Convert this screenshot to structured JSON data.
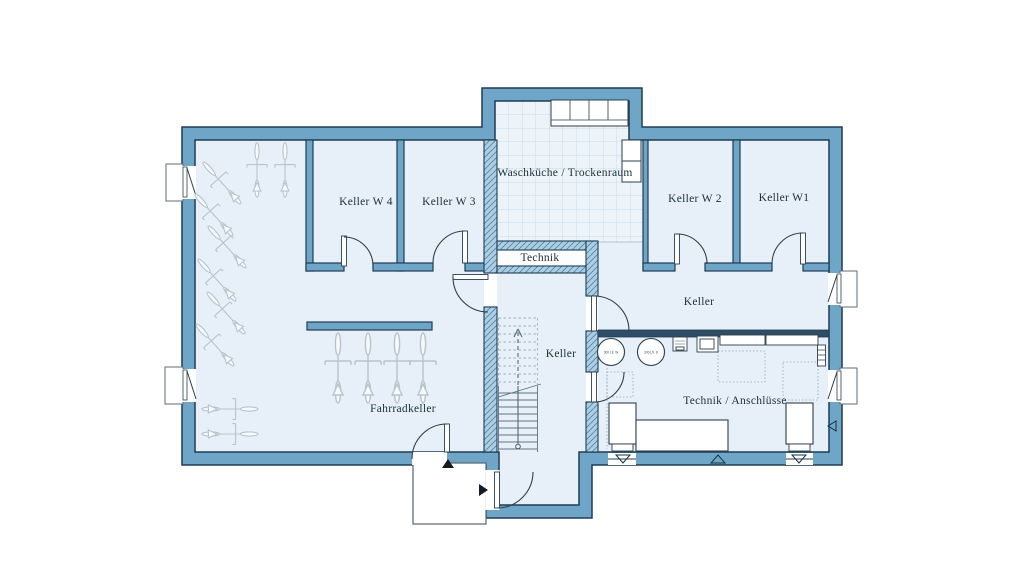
{
  "rooms": [
    {
      "id": "keller-w4",
      "label": "Keller W 4"
    },
    {
      "id": "keller-w3",
      "label": "Keller W 3"
    },
    {
      "id": "waschkueche",
      "label": "Waschküche / Trockenraum"
    },
    {
      "id": "keller-w2",
      "label": "Keller W 2"
    },
    {
      "id": "keller-w1",
      "label": "Keller W1"
    },
    {
      "id": "technik",
      "label": "Technik"
    },
    {
      "id": "keller-mitte",
      "label": "Keller"
    },
    {
      "id": "keller-rechts",
      "label": "Keller"
    },
    {
      "id": "fahrradkeller",
      "label": "Fahrradkeller"
    },
    {
      "id": "technik-anschluesse",
      "label": "Technik / Anschlüsse"
    }
  ],
  "tanks": {
    "t1": "300 Ltr. W",
    "t2": "300 Ltr. S"
  },
  "colors": {
    "wall_fill": "#6FA6C8",
    "wall_outline": "#1E3D54",
    "room_fill": "#E7F0F8",
    "hatch_wall_fill": "#AECFE3",
    "hatch_line": "#5288A8",
    "dark_partition": "#2E4E66",
    "tile_line": "#C6DCEA",
    "bike_line": "#B9C3CD",
    "background": "#FFFFFF"
  }
}
